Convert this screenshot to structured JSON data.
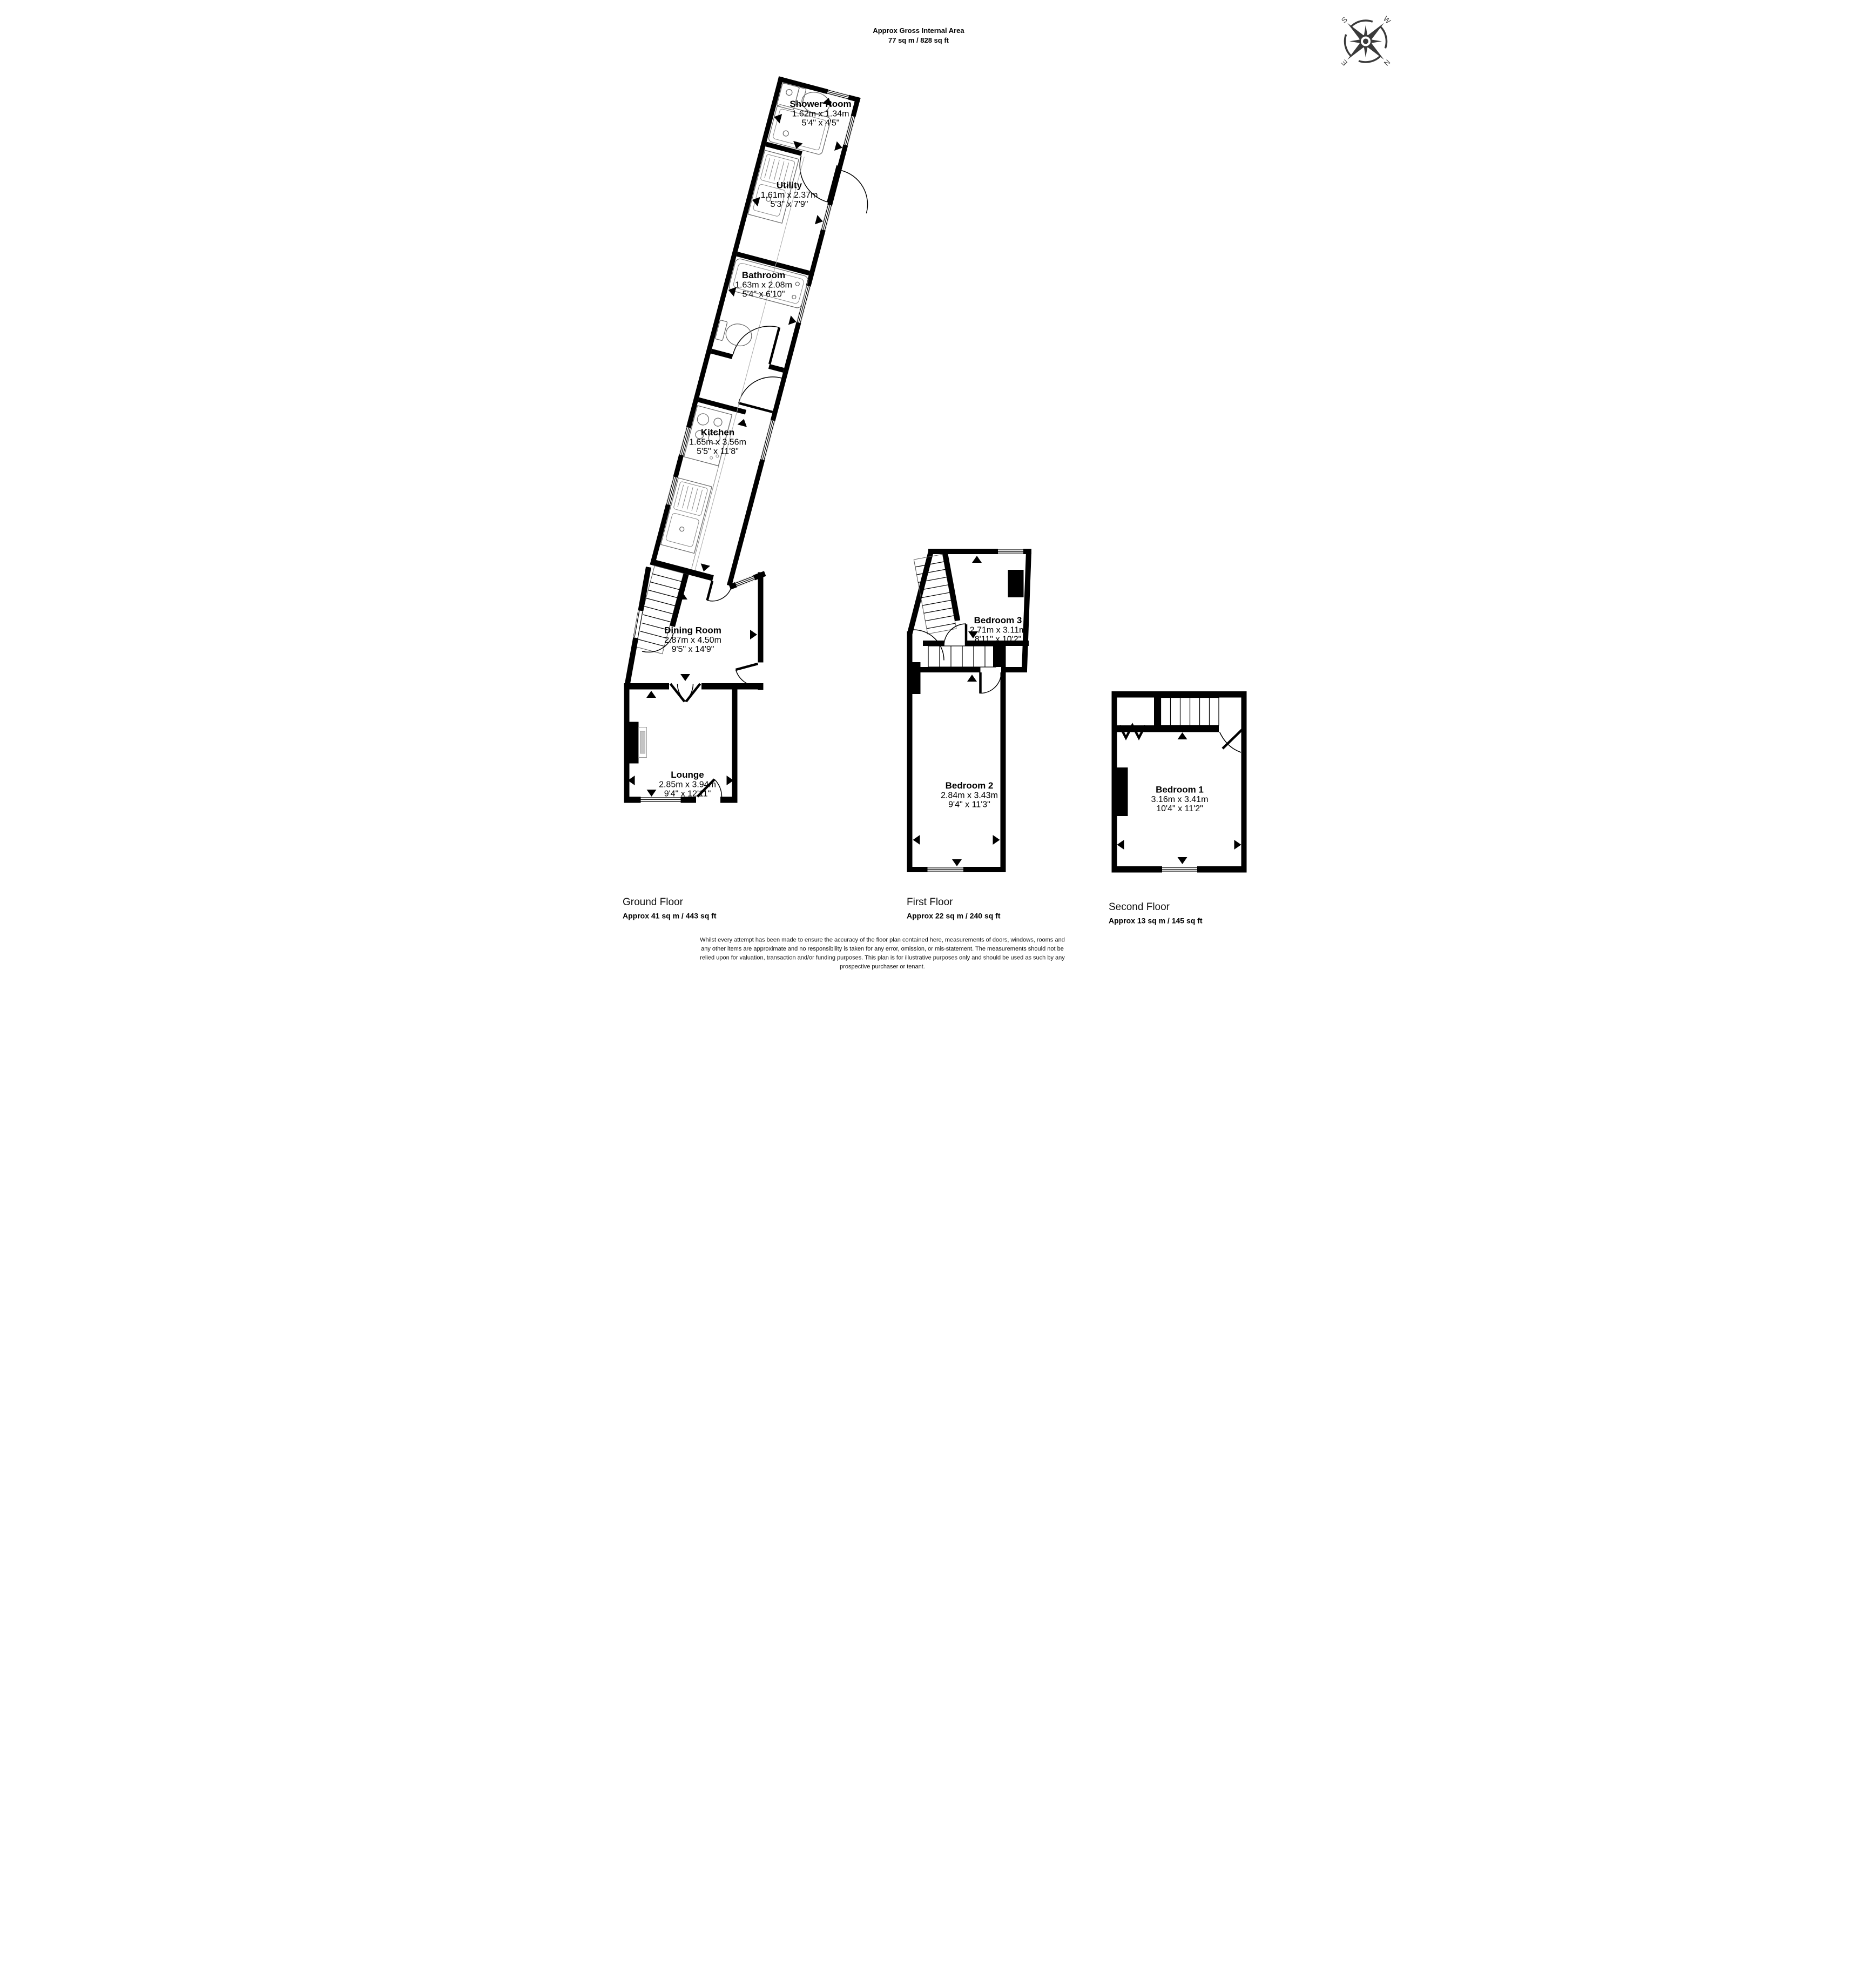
{
  "header": {
    "line1": "Approx Gross Internal Area",
    "line2": "77 sq m / 828 sq ft"
  },
  "compass": {
    "n": "N",
    "e": "E",
    "s": "S",
    "w": "W"
  },
  "ground": {
    "title": "Ground Floor",
    "area": "Approx 41 sq m / 443 sq ft",
    "rooms": {
      "shower_room": {
        "name": "Shower Room",
        "metric": "1.62m x 1.34m",
        "imperial": "5'4\" x 4'5\""
      },
      "utility": {
        "name": "Utility",
        "metric": "1.61m x 2.37m",
        "imperial": "5'3\" x 7'9\""
      },
      "bathroom": {
        "name": "Bathroom",
        "metric": "1.63m x 2.08m",
        "imperial": "5'4\" x 6'10\""
      },
      "kitchen": {
        "name": "Kitchen",
        "metric": "1.65m x 3.56m",
        "imperial": "5'5\" x 11'8\""
      },
      "dining_room": {
        "name": "Dining Room",
        "metric": "2.87m x 4.50m",
        "imperial": "9'5\" x 14'9\""
      },
      "lounge": {
        "name": "Lounge",
        "metric": "2.85m x 3.94m",
        "imperial": "9'4\" x 12'11\""
      }
    }
  },
  "first": {
    "title": "First Floor",
    "area": "Approx 22 sq m / 240 sq ft",
    "rooms": {
      "bedroom_3": {
        "name": "Bedroom 3",
        "metric": "2.71m x 3.11m",
        "imperial": "8'11\" x 10'2\""
      },
      "bedroom_2": {
        "name": "Bedroom 2",
        "metric": "2.84m x 3.43m",
        "imperial": "9'4\" x 11'3\""
      }
    }
  },
  "second": {
    "title": "Second Floor",
    "area": "Approx 13 sq m / 145 sq ft",
    "rooms": {
      "bedroom_1": {
        "name": "Bedroom 1",
        "metric": "3.16m x 3.41m",
        "imperial": "10'4\" x 11'2\""
      }
    }
  },
  "disclaimer": {
    "line1": "Whilst every attempt has been made to ensure the accuracy of the floor plan contained here, measurements of doors, windows, rooms and",
    "line2": "any other items are approximate and no responsibility is taken for any error, omission, or mis-statement. The measurements should not be",
    "line3": "relied upon for valuation, transaction and/or funding purposes. This plan is for illustrative purposes only and should be used as such by any",
    "line4": "prospective purchaser or tenant."
  }
}
